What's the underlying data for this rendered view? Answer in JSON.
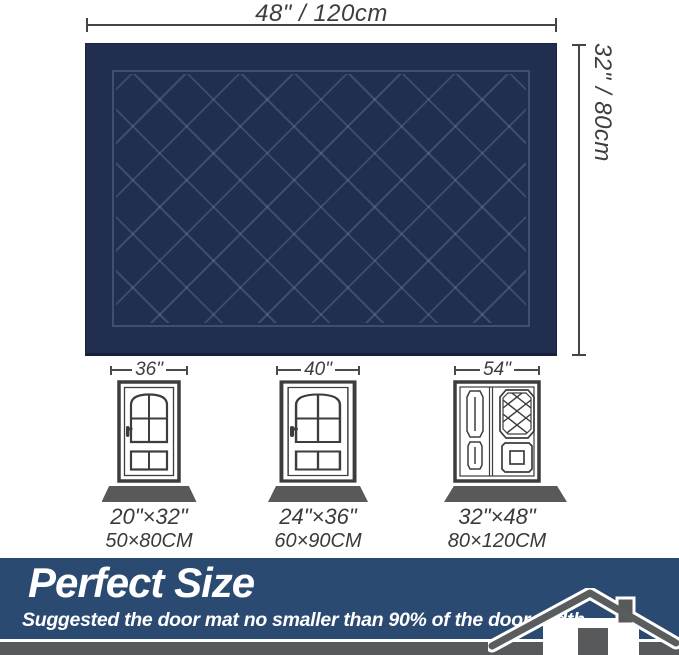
{
  "mat": {
    "width_label": "48\" / 120cm",
    "height_label": "32\" / 80cm",
    "color": "#212e4f"
  },
  "doors": [
    {
      "door_width": "36\"",
      "type": "single-door",
      "mat_size_in": "20\"×32\"",
      "mat_size_cm": "50×80CM"
    },
    {
      "door_width": "40\"",
      "type": "single-door",
      "mat_size_in": "24\"×36\"",
      "mat_size_cm": "60×90CM"
    },
    {
      "door_width": "54\"",
      "type": "double-door",
      "mat_size_in": "32\"×48\"",
      "mat_size_cm": "80×120CM"
    }
  ],
  "banner": {
    "title": "Perfect Size",
    "subtitle": "Suggested the door mat no smaller than 90% of the door width.",
    "background": "#2b4a72"
  },
  "icons": {
    "house": "house-icon"
  }
}
